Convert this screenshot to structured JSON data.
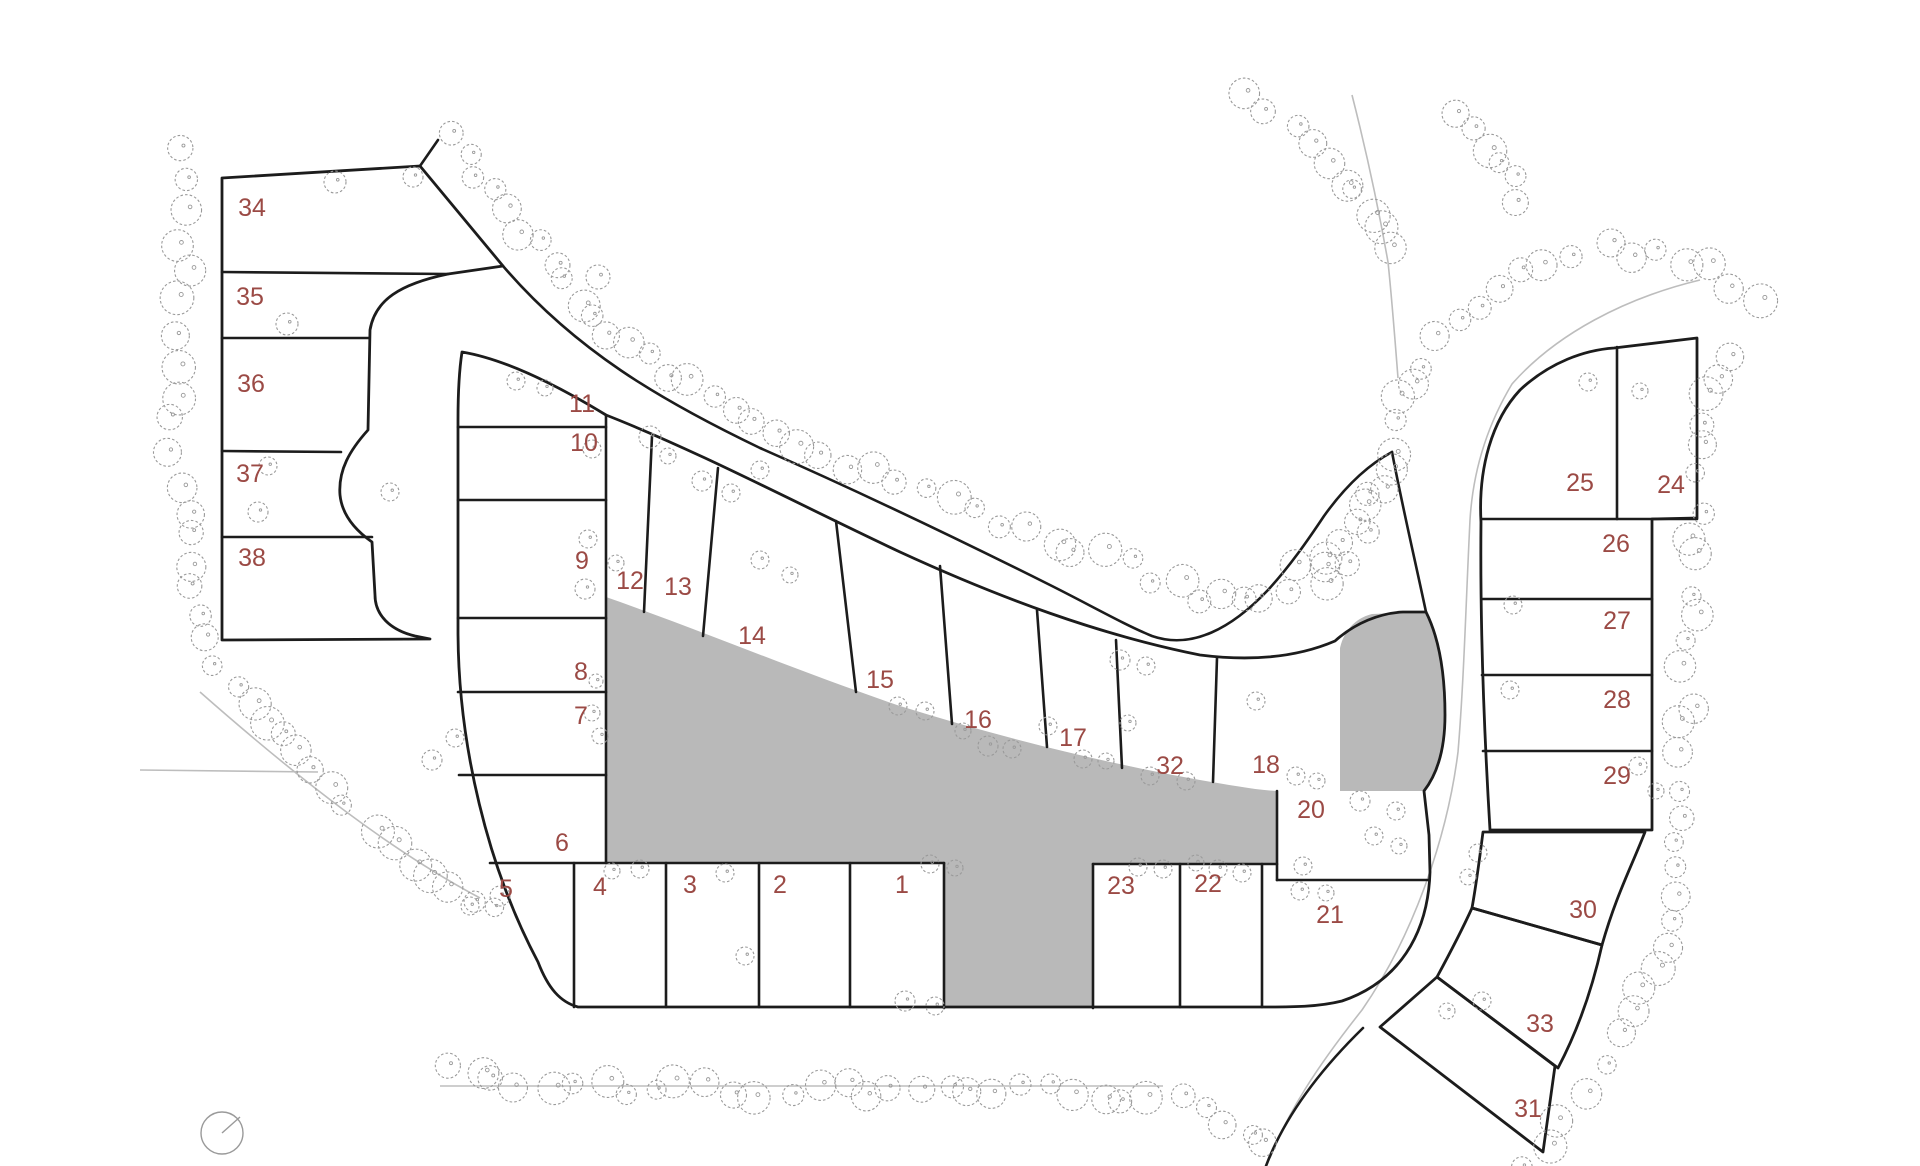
{
  "map": {
    "kind": "land-subdivision-site-plan",
    "width": 1920,
    "height": 1166,
    "colors": {
      "background": "#ffffff",
      "parcel_line": "#1c1c1c",
      "reserved_area_fill": "#b9b9b9",
      "tree_stroke": "#9a9a9a",
      "thin_edge_line": "#bdbdbd",
      "lot_number_text": "#9b4a45"
    },
    "lot_label_font_size": 25,
    "lots": [
      {
        "number": "1",
        "x": 902,
        "y": 884
      },
      {
        "number": "2",
        "x": 780,
        "y": 884
      },
      {
        "number": "3",
        "x": 690,
        "y": 884
      },
      {
        "number": "4",
        "x": 600,
        "y": 886
      },
      {
        "number": "5",
        "x": 506,
        "y": 888
      },
      {
        "number": "6",
        "x": 562,
        "y": 842
      },
      {
        "number": "7",
        "x": 581,
        "y": 715
      },
      {
        "number": "8",
        "x": 581,
        "y": 671
      },
      {
        "number": "9",
        "x": 582,
        "y": 560
      },
      {
        "number": "10",
        "x": 584,
        "y": 442
      },
      {
        "number": "11",
        "x": 582,
        "y": 403
      },
      {
        "number": "12",
        "x": 630,
        "y": 580
      },
      {
        "number": "13",
        "x": 678,
        "y": 586
      },
      {
        "number": "14",
        "x": 752,
        "y": 635
      },
      {
        "number": "15",
        "x": 880,
        "y": 679
      },
      {
        "number": "16",
        "x": 978,
        "y": 719
      },
      {
        "number": "17",
        "x": 1073,
        "y": 737
      },
      {
        "number": "32",
        "x": 1170,
        "y": 765
      },
      {
        "number": "18",
        "x": 1266,
        "y": 764
      },
      {
        "number": "20",
        "x": 1311,
        "y": 809
      },
      {
        "number": "21",
        "x": 1330,
        "y": 914
      },
      {
        "number": "22",
        "x": 1208,
        "y": 883
      },
      {
        "number": "23",
        "x": 1121,
        "y": 885
      },
      {
        "number": "24",
        "x": 1671,
        "y": 484
      },
      {
        "number": "25",
        "x": 1580,
        "y": 482
      },
      {
        "number": "26",
        "x": 1616,
        "y": 543
      },
      {
        "number": "27",
        "x": 1617,
        "y": 620
      },
      {
        "number": "28",
        "x": 1617,
        "y": 699
      },
      {
        "number": "29",
        "x": 1617,
        "y": 775
      },
      {
        "number": "30",
        "x": 1583,
        "y": 909
      },
      {
        "number": "33",
        "x": 1540,
        "y": 1023
      },
      {
        "number": "31",
        "x": 1528,
        "y": 1108
      },
      {
        "number": "34",
        "x": 252,
        "y": 207
      },
      {
        "number": "35",
        "x": 250,
        "y": 296
      },
      {
        "number": "36",
        "x": 251,
        "y": 383
      },
      {
        "number": "37",
        "x": 250,
        "y": 473
      },
      {
        "number": "38",
        "x": 252,
        "y": 557
      }
    ],
    "blocks": [
      {
        "name": "block-west-34-38",
        "path": "M222,178 L420,166 L503,266 L448,274 C400,284 375,300 370,330 L368,430 C350,450 338,470 340,495 C342,515 355,530 372,542 L375,595 C375,615 390,630 415,636 L430,639 L222,640 Z"
      },
      {
        "name": "block-central-ring",
        "path": "M462,352 C510,360 565,390 606,415 C700,452 800,505 900,552 C1000,598 1100,635 1200,655 C1255,662 1300,656 1335,641 C1355,623 1380,613 1403,612 L1426,612 C1440,640 1445,678 1445,715 C1445,748 1438,773 1424,791 L1429,835 L1430,872 C1428,935 1398,982 1342,1001 C1318,1007 1292,1007 1266,1007 L578,1007 C560,1002 548,988 538,962 C488,868 458,745 458,630 L458,420 C458,390 460,365 462,352 Z"
      },
      {
        "name": "block-east-24-29",
        "path": "M1481,522 C1478,468 1492,420 1520,390 C1550,362 1585,350 1614,348 L1697,338 L1697,518 L1652,519 L1652,830 L1490,830 C1484,730 1480,620 1481,522 Z"
      },
      {
        "name": "lot-30-parcel",
        "path": "M1483,832 L1645,832 C1630,870 1616,896 1602,945 L1472,908 C1477,880 1480,855 1483,832 Z"
      },
      {
        "name": "lot-33-parcel",
        "path": "M1472,908 L1602,945 C1592,990 1578,1030 1558,1068 L1437,977 C1450,953 1462,930 1472,908 Z"
      },
      {
        "name": "lot-31-parcel",
        "path": "M1380,1027 L1437,977 L1555,1066 L1543,1152 Z"
      }
    ],
    "reserved_areas": [
      {
        "name": "central-reserved-area",
        "path": "M606,597 C700,630 800,672 900,706 C1000,737 1100,762 1200,780 C1230,785 1256,790 1277,791 L1277,863 L1093,863 L1093,1008 L944,1008 L944,863 L606,863 Z"
      },
      {
        "name": "east-reserved-parcel",
        "path": "M1340,648 C1344,630 1356,618 1372,614 L1426,612 C1440,640 1445,678 1445,715 C1445,748 1438,773 1424,791 L1340,791 Z"
      }
    ],
    "boundary_lines": [
      "M222,272 L448,274",
      "M222,338 L369,338",
      "M222,451 L341,452",
      "M222,537 L372,537",
      "M438,140 L420,166",
      "M503,266 C575,350 660,400 760,448 C860,492 960,540 1050,585 C1090,605 1125,625 1152,636 C1192,650 1232,628 1268,590 C1290,566 1308,540 1324,516 C1344,488 1366,466 1392,452",
      "M1426,612 C1415,560 1402,505 1392,452",
      "M606,415 L606,863",
      "M458,427 L606,427",
      "M458,500 L606,500",
      "M458,618 L606,618",
      "M458,692 L606,692",
      "M459,775 L606,775",
      "M490,863 L944,863",
      "M1093,864 L1277,864",
      "M1277,880 L1429,880",
      "M574,863 L574,1007",
      "M666,863 L666,1007",
      "M759,863 L759,1007",
      "M850,863 L850,1007",
      "M944,863 L944,1008",
      "M1093,864 L1093,1008",
      "M1180,864 L1180,1007",
      "M1262,864 L1262,1007",
      "M1277,791 L1277,880",
      "M652,436 L644,612",
      "M718,468 L703,636",
      "M836,521 L856,692",
      "M940,566 L952,724",
      "M1037,610 L1047,747",
      "M1116,640 L1122,768",
      "M1217,658 L1213,782",
      "M1481,519 L1697,519",
      "M1617,347 L1617,519",
      "M1483,599 L1652,599",
      "M1482,675 L1652,675",
      "M1483,751 L1652,751",
      "M1363,1028 C1318,1072 1284,1118 1266,1166"
    ],
    "thin_edge_lines": [
      "M1700,280 C1625,298 1556,334 1512,384 C1488,424 1473,470 1470,520 C1466,600 1464,680 1458,752 C1448,832 1416,932 1362,1010 C1316,1068 1288,1112 1270,1158",
      "M1352,95 C1366,150 1378,205 1388,262 C1392,300 1395,340 1398,378",
      "M140,770 L318,772",
      "M440,1086 L1163,1086",
      "M200,692 C300,780 390,850 480,898"
    ],
    "tree_bands": [
      {
        "name": "west-and-southwest-band",
        "step": 27,
        "points": [
          [
            186,
            148
          ],
          [
            178,
            210
          ],
          [
            186,
            270
          ],
          [
            174,
            330
          ],
          [
            182,
            390
          ],
          [
            172,
            450
          ],
          [
            182,
            510
          ],
          [
            190,
            565
          ],
          [
            200,
            615
          ],
          [
            218,
            662
          ],
          [
            248,
            700
          ],
          [
            282,
            738
          ],
          [
            316,
            775
          ],
          [
            350,
            812
          ],
          [
            390,
            845
          ],
          [
            432,
            872
          ],
          [
            474,
            893
          ],
          [
            516,
            908
          ]
        ]
      },
      {
        "name": "south-band",
        "step": 27,
        "points": [
          [
            452,
            1072
          ],
          [
            520,
            1082
          ],
          [
            600,
            1088
          ],
          [
            680,
            1090
          ],
          [
            760,
            1092
          ],
          [
            840,
            1090
          ],
          [
            920,
            1088
          ],
          [
            1000,
            1090
          ],
          [
            1080,
            1092
          ],
          [
            1150,
            1096
          ],
          [
            1205,
            1110
          ],
          [
            1248,
            1135
          ],
          [
            1282,
            1160
          ]
        ]
      },
      {
        "name": "southeast-band",
        "step": 27,
        "points": [
          [
            1530,
            1162
          ],
          [
            1565,
            1115
          ],
          [
            1600,
            1065
          ],
          [
            1630,
            1015
          ],
          [
            1652,
            965
          ],
          [
            1668,
            915
          ],
          [
            1676,
            862
          ],
          [
            1680,
            810
          ],
          [
            1683,
            755
          ],
          [
            1686,
            700
          ],
          [
            1688,
            645
          ],
          [
            1692,
            590
          ],
          [
            1696,
            535
          ],
          [
            1700,
            480
          ],
          [
            1706,
            425
          ],
          [
            1718,
            375
          ],
          [
            1740,
            330
          ]
        ]
      },
      {
        "name": "northeast-arc-band",
        "step": 27,
        "points": [
          [
            1758,
            300
          ],
          [
            1712,
            272
          ],
          [
            1660,
            255
          ],
          [
            1605,
            250
          ],
          [
            1550,
            262
          ],
          [
            1498,
            285
          ],
          [
            1455,
            320
          ],
          [
            1422,
            362
          ],
          [
            1405,
            405
          ],
          [
            1398,
            448
          ],
          [
            1382,
            492
          ],
          [
            1360,
            535
          ],
          [
            1332,
            575
          ],
          [
            1305,
            608
          ]
        ]
      },
      {
        "name": "north-diagonal-band",
        "step": 27,
        "points": [
          [
            450,
            140
          ],
          [
            480,
            175
          ],
          [
            508,
            212
          ],
          [
            536,
            248
          ],
          [
            565,
            282
          ],
          [
            596,
            314
          ],
          [
            630,
            345
          ],
          [
            668,
            374
          ],
          [
            708,
            400
          ],
          [
            752,
            424
          ],
          [
            798,
            446
          ],
          [
            846,
            466
          ],
          [
            896,
            486
          ],
          [
            948,
            505
          ],
          [
            1000,
            523
          ],
          [
            1052,
            540
          ],
          [
            1104,
            557
          ],
          [
            1152,
            575
          ],
          [
            1196,
            594
          ],
          [
            1240,
            600
          ],
          [
            1284,
            583
          ],
          [
            1324,
            554
          ],
          [
            1358,
            520
          ],
          [
            1386,
            482
          ]
        ]
      },
      {
        "name": "top-entry-west-band",
        "step": 26,
        "points": [
          [
            1240,
            100
          ],
          [
            1270,
            120
          ],
          [
            1302,
            128
          ],
          [
            1330,
            162
          ],
          [
            1356,
            198
          ],
          [
            1378,
            236
          ],
          [
            1394,
            272
          ]
        ]
      },
      {
        "name": "top-entry-east-band",
        "step": 26,
        "points": [
          [
            1452,
            118
          ],
          [
            1482,
            150
          ],
          [
            1508,
            185
          ],
          [
            1528,
            222
          ]
        ]
      }
    ],
    "scattered_trees": [
      [
        335,
        182,
        11
      ],
      [
        413,
        177,
        10
      ],
      [
        598,
        277,
        12
      ],
      [
        287,
        324,
        11
      ],
      [
        650,
        437,
        11
      ],
      [
        268,
        466,
        9
      ],
      [
        258,
        512,
        10
      ],
      [
        592,
        449,
        9
      ],
      [
        588,
        539,
        9
      ],
      [
        585,
        589,
        10
      ],
      [
        616,
        563,
        8
      ],
      [
        702,
        481,
        10
      ],
      [
        731,
        493,
        9
      ],
      [
        668,
        456,
        8
      ],
      [
        760,
        470,
        9
      ],
      [
        516,
        381,
        9
      ],
      [
        545,
        388,
        8
      ],
      [
        898,
        706,
        9
      ],
      [
        925,
        711,
        9
      ],
      [
        988,
        746,
        10
      ],
      [
        1012,
        749,
        9
      ],
      [
        963,
        731,
        8
      ],
      [
        1048,
        726,
        9
      ],
      [
        1083,
        759,
        9
      ],
      [
        1106,
        761,
        8
      ],
      [
        1150,
        776,
        9
      ],
      [
        1186,
        781,
        9
      ],
      [
        1128,
        723,
        8
      ],
      [
        1256,
        701,
        9
      ],
      [
        1296,
        776,
        9
      ],
      [
        1317,
        781,
        8
      ],
      [
        1360,
        801,
        10
      ],
      [
        1396,
        811,
        9
      ],
      [
        1374,
        836,
        9
      ],
      [
        1399,
        846,
        8
      ],
      [
        1303,
        866,
        9
      ],
      [
        1218,
        869,
        9
      ],
      [
        1242,
        873,
        9
      ],
      [
        1196,
        863,
        8
      ],
      [
        1138,
        867,
        9
      ],
      [
        1163,
        869,
        9
      ],
      [
        1300,
        891,
        9
      ],
      [
        1326,
        893,
        8
      ],
      [
        745,
        956,
        9
      ],
      [
        725,
        873,
        9
      ],
      [
        640,
        869,
        9
      ],
      [
        612,
        871,
        8
      ],
      [
        500,
        896,
        10
      ],
      [
        470,
        906,
        9
      ],
      [
        905,
        1001,
        10
      ],
      [
        935,
        1006,
        9
      ],
      [
        930,
        864,
        9
      ],
      [
        955,
        868,
        8
      ],
      [
        592,
        713,
        8
      ],
      [
        600,
        736,
        8
      ],
      [
        596,
        681,
        7
      ],
      [
        432,
        760,
        10
      ],
      [
        455,
        738,
        9
      ],
      [
        390,
        492,
        9
      ],
      [
        1513,
        605,
        9
      ],
      [
        1510,
        690,
        9
      ],
      [
        1638,
        766,
        9
      ],
      [
        1656,
        791,
        8
      ],
      [
        1478,
        853,
        9
      ],
      [
        1468,
        877,
        8
      ],
      [
        1588,
        382,
        9
      ],
      [
        1640,
        391,
        8
      ],
      [
        1482,
        1001,
        9
      ],
      [
        1447,
        1011,
        8
      ],
      [
        1120,
        660,
        10
      ],
      [
        1146,
        666,
        9
      ],
      [
        760,
        560,
        9
      ],
      [
        790,
        575,
        8
      ]
    ],
    "north_marker": {
      "x": 222,
      "y": 1133,
      "r": 21,
      "tick_dx": 18,
      "tick_dy": -16
    }
  }
}
